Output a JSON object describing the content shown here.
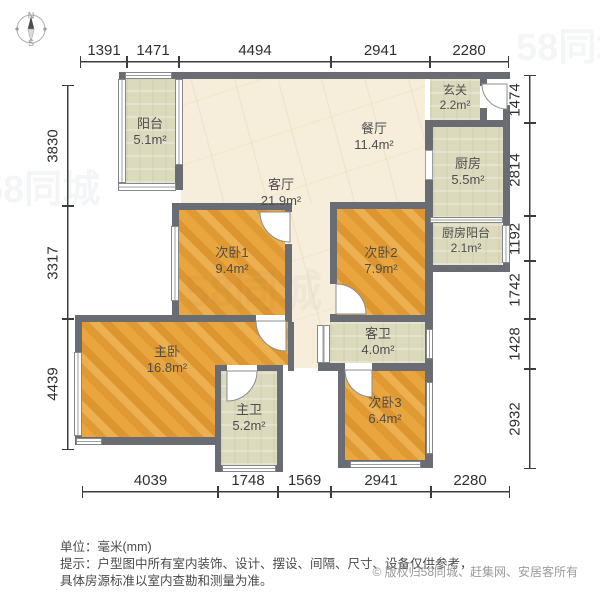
{
  "compass": {
    "north": "N",
    "south": "S"
  },
  "rooms": {
    "balcony": {
      "name": "阳台",
      "area": "5.1m²"
    },
    "living": {
      "name": "客厅",
      "area": "21.9m²"
    },
    "dining": {
      "name": "餐厅",
      "area": "11.4m²"
    },
    "entry": {
      "name": "玄关",
      "area": "2.2m²"
    },
    "kitchen": {
      "name": "厨房",
      "area": "5.5m²"
    },
    "kitchen_balcony": {
      "name": "厨房阳台",
      "area": "2.1m²"
    },
    "bedroom1": {
      "name": "次卧1",
      "area": "9.4m²"
    },
    "bedroom2": {
      "name": "次卧2",
      "area": "7.9m²"
    },
    "bedroom3": {
      "name": "次卧3",
      "area": "6.4m²"
    },
    "master": {
      "name": "主卧",
      "area": "16.8m²"
    },
    "master_bath": {
      "name": "主卫",
      "area": "5.2m²"
    },
    "guest_bath": {
      "name": "客卫",
      "area": "4.0m²"
    }
  },
  "dims": {
    "top": [
      "1391",
      "1471",
      "4494",
      "2941",
      "2280"
    ],
    "bottom": [
      "4039",
      "1748",
      "1569",
      "2941",
      "2280"
    ],
    "left": [
      "3830",
      "3317",
      "4439"
    ],
    "right": [
      "1474",
      "2814",
      "1192",
      "1742",
      "1428",
      "2932"
    ]
  },
  "watermark": {
    "brand": "58同城"
  },
  "footer": {
    "unit_label": "单位：毫米(mm)",
    "tip_line1": "提示：户型图中所有室内装饰、设计、摆设、间隔、尺寸、设备仅供参考，",
    "tip_line2": "具体房源标准以室内查勘和测量为准。",
    "copyright_symbol": "©",
    "copyright": "版权归58同城、赶集网、安居客所有"
  }
}
